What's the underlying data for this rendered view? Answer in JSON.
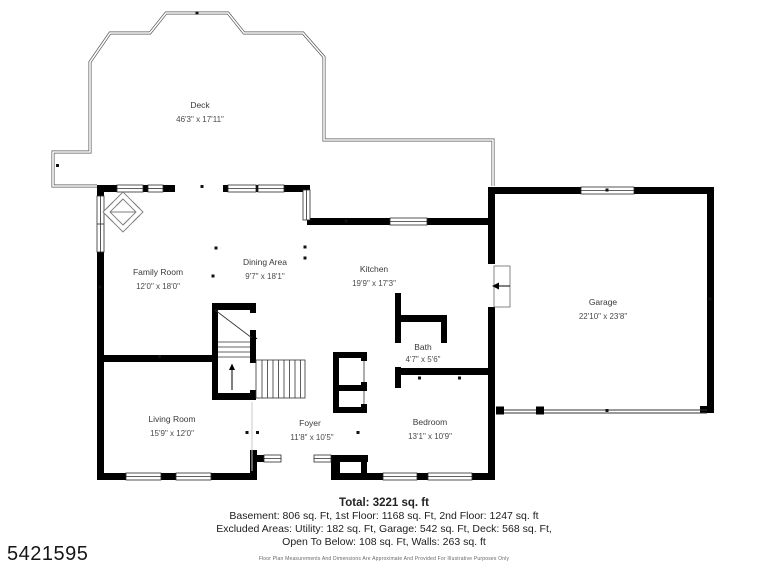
{
  "plan_id": "5421595",
  "rooms": [
    {
      "name": "Deck",
      "dims": "46'3\" x 17'11\""
    },
    {
      "name": "Family Room",
      "dims": "12'0\" x 18'0\""
    },
    {
      "name": "Dining Area",
      "dims": "9'7\" x 18'1\""
    },
    {
      "name": "Kitchen",
      "dims": "19'9\" x 17'3\""
    },
    {
      "name": "Garage",
      "dims": "22'10\" x 23'8\""
    },
    {
      "name": "Bath",
      "dims": "4'7\" x 5'6\""
    },
    {
      "name": "Living Room",
      "dims": "15'9\" x 12'0\""
    },
    {
      "name": "Foyer",
      "dims": "11'8\" x 10'5\""
    },
    {
      "name": "Bedroom",
      "dims": "13'1\" x 10'9\""
    }
  ],
  "summary": {
    "total": "Total: 3221 sq. ft",
    "line1": "Basement: 806 sq. Ft, 1st Floor: 1168 sq. Ft, 2nd Floor: 1247 sq. ft",
    "line2": "Excluded Areas: Utility: 182 sq. Ft, Garage: 542 sq. Ft, Deck: 568 sq. Ft,",
    "line3": "Open To Below: 108 sq. Ft, Walls: 263 sq. ft",
    "disclaimer": "Floor Plan Measurements And Dimensions Are Approximate And Provided For Illustrative Purposes Only"
  },
  "colors": {
    "wall": "#000000",
    "deck_line": "#555555",
    "label": "#3a3a3a"
  }
}
